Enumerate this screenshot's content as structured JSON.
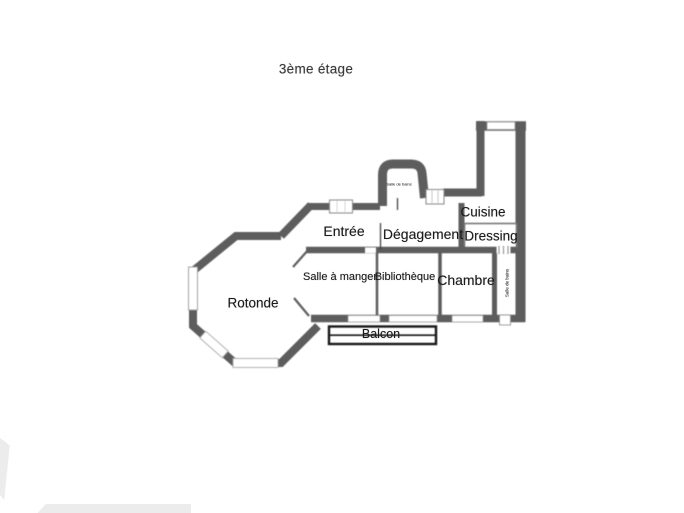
{
  "title": "3ème étage",
  "rooms": {
    "rotonde": "Rotonde",
    "entree": "Entrée",
    "degagement": "Dégagement",
    "cuisine": "Cuisine",
    "dressing": "Dressing",
    "salle_a_manger": "Salle à manger",
    "bibliotheque": "Bibliothèque",
    "chambre": "Chambre",
    "salle_de_bains": "Salle de bains",
    "small_room": "Salle de bains",
    "balcon": "Balcon"
  },
  "colors": {
    "wall": "#5d5d5d",
    "label_text": "#1b1b1b",
    "balcony_border": "#161616",
    "window_line": "#999999",
    "background": "#ffffff"
  }
}
